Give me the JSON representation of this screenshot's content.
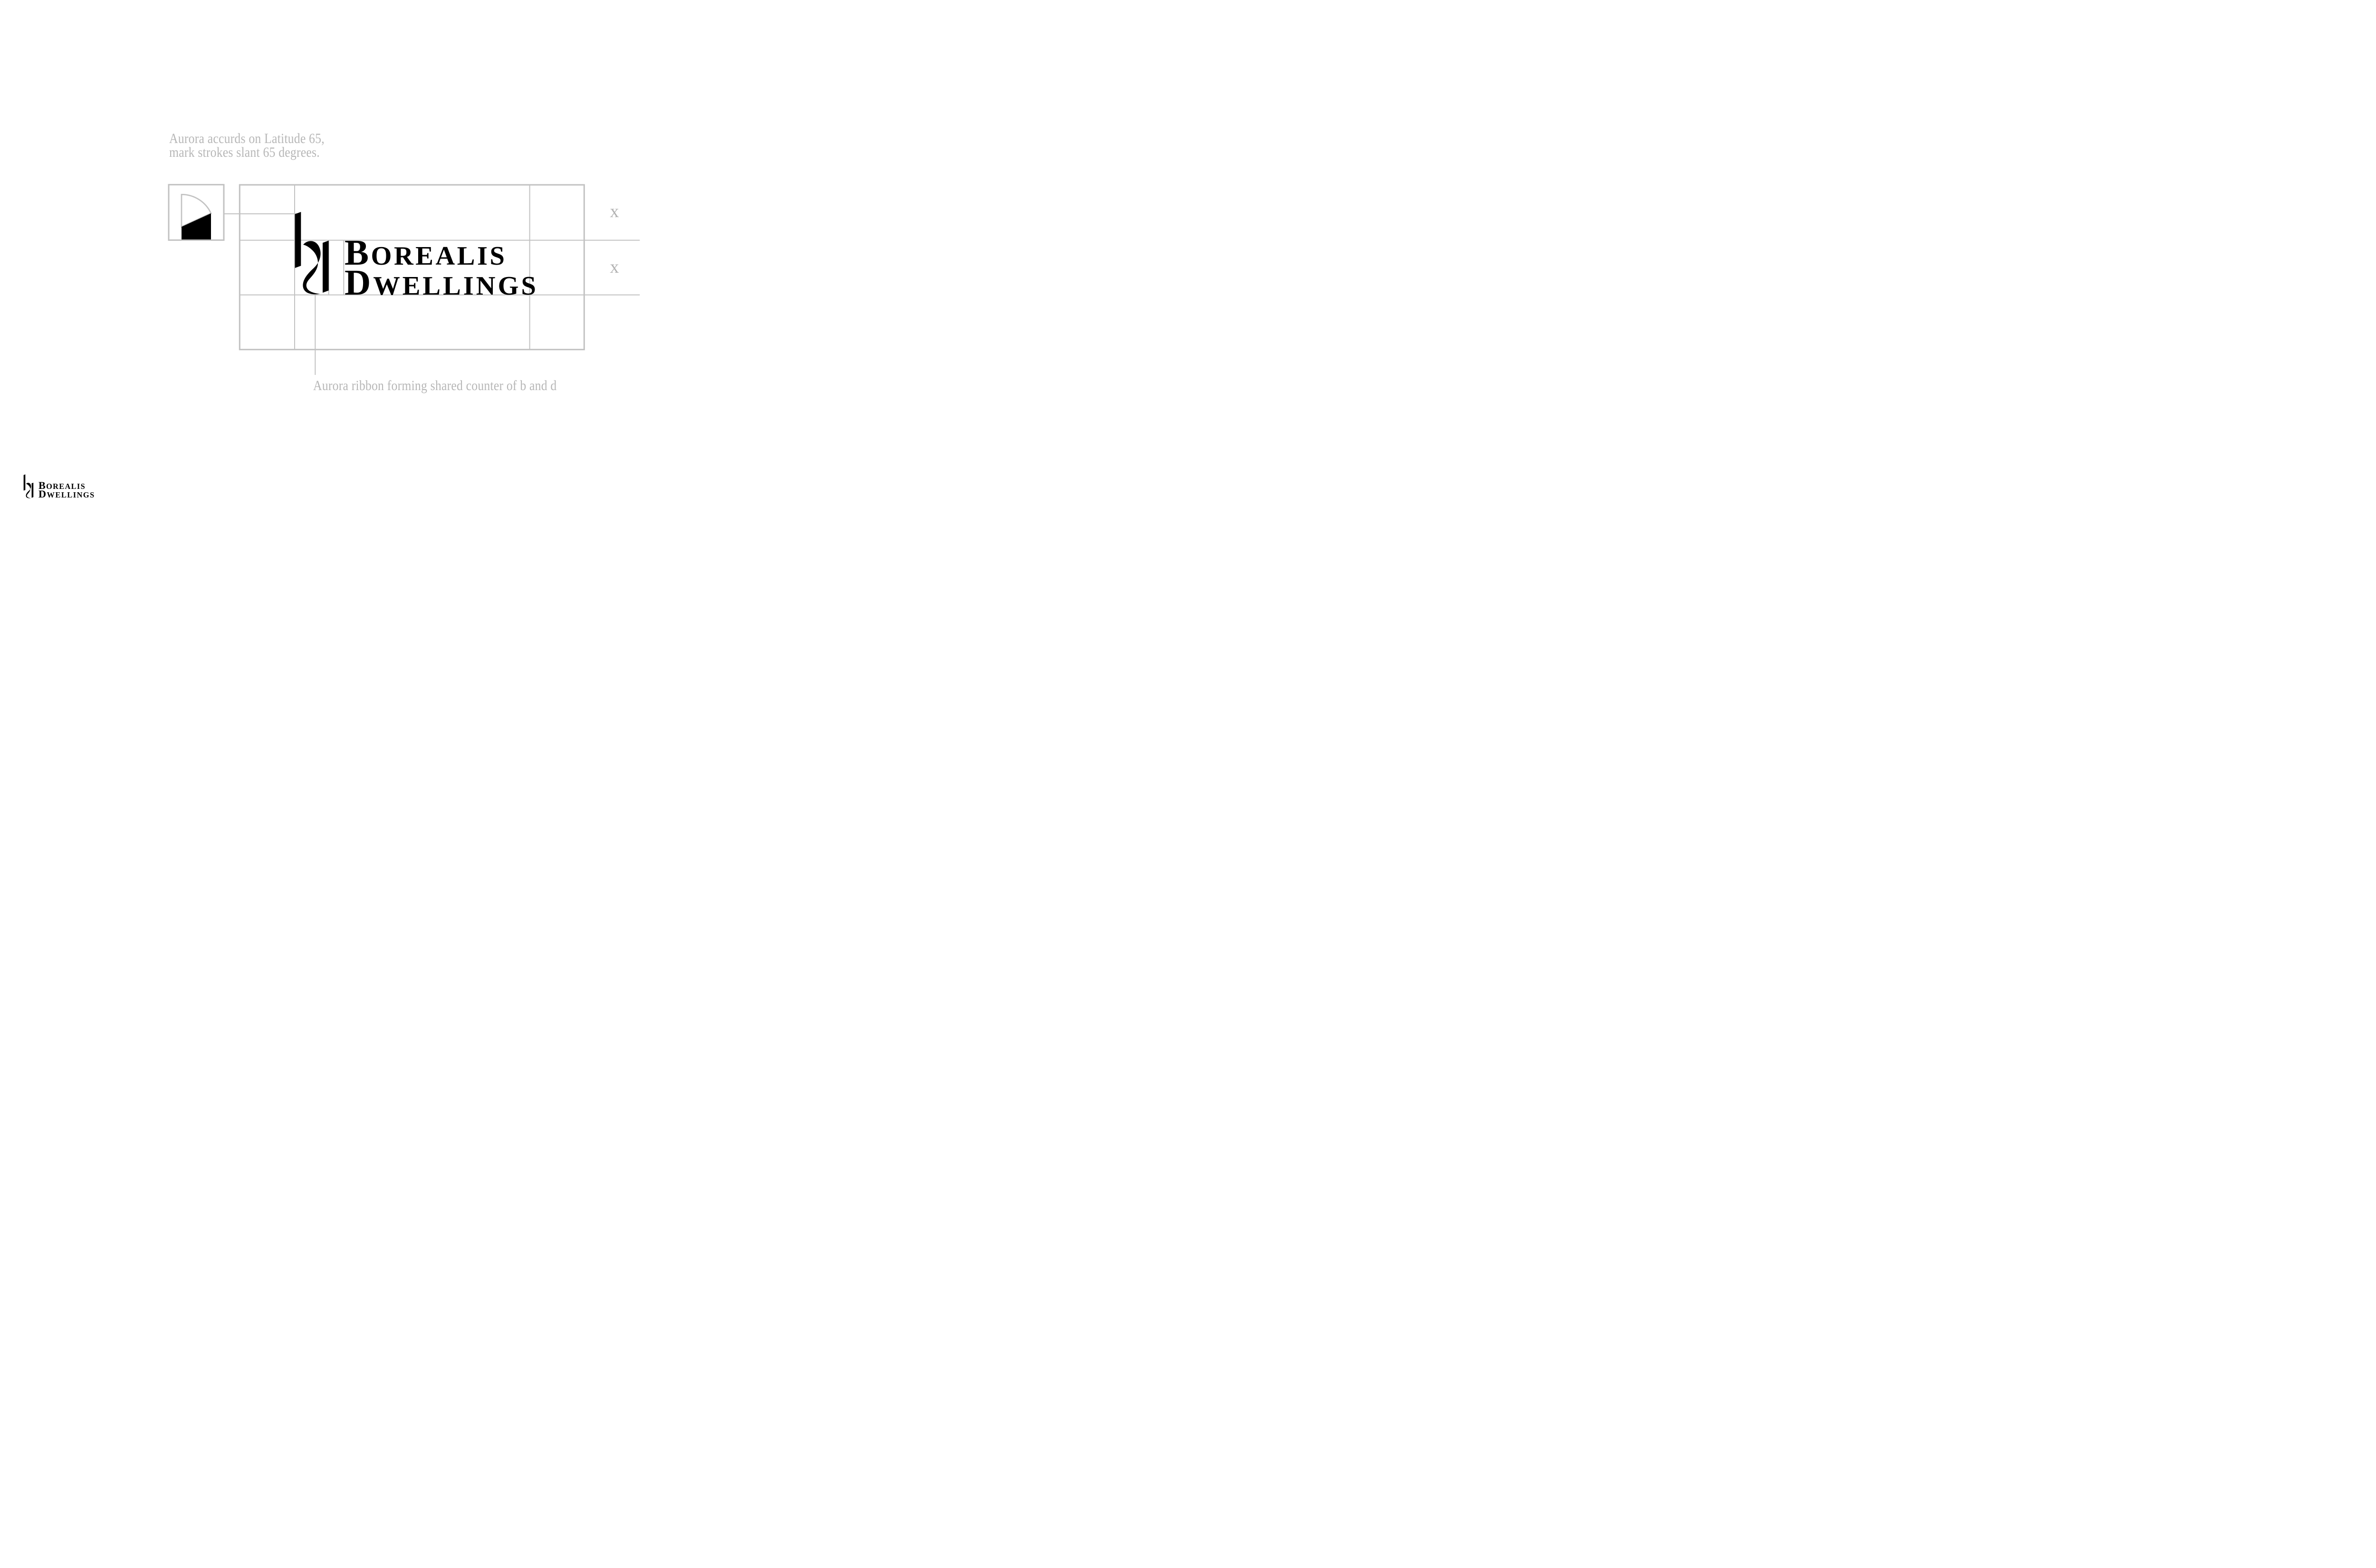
{
  "captions": {
    "slant_line1": "Aurora accurds on Latitude 65,",
    "slant_line2": "mark strokes slant 65 degrees.",
    "ribbon": "Aurora ribbon forming shared counter of b and d"
  },
  "measurements": {
    "x_unit_row1": "x",
    "x_unit_row2": "x"
  },
  "wordmark": {
    "line1_initial": "B",
    "line1_rest": "OREALIS",
    "line2_initial": "D",
    "line2_rest": "WELLINGS"
  },
  "colors": {
    "ink": "#000000",
    "guide_gray": "#c2c2c2",
    "caption_gray": "#b7b7b7",
    "label_gray": "#b3b3b3",
    "background": "#ffffff"
  }
}
